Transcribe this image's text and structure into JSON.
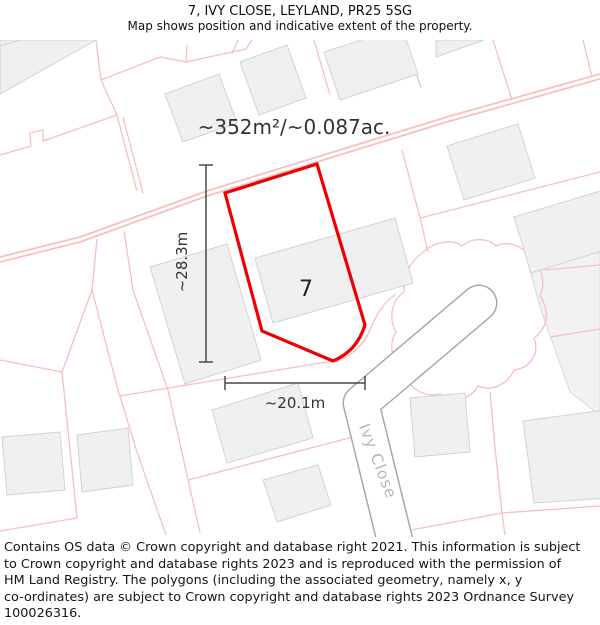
{
  "header": {
    "title": "7, IVY CLOSE, LEYLAND, PR25 5SG",
    "subtitle": "Map shows position and indicative extent of the property."
  },
  "map": {
    "area_label": "~352m²/~0.087ac.",
    "plot_number": "7",
    "dim_vertical_label": "~28.3m",
    "dim_horizontal_label": "~20.1m",
    "street_label": "Ivy Close",
    "colors": {
      "plot_outline": "#ee0000",
      "parcel_line": "#f8bfbf",
      "building_fill": "#f0f0f0",
      "building_stroke": "#d2d2d2",
      "road_casing": "#a8a8a8",
      "street_text": "#b6b6b6"
    }
  },
  "footer": {
    "lines": [
      "Contains OS data © Crown copyright and database right 2021. This information is subject",
      "to Crown copyright and database rights 2023 and is reproduced with the permission of",
      "HM Land Registry. The polygons (including the associated geometry, namely x, y",
      "co-ordinates) are subject to Crown copyright and database rights 2023 Ordnance Survey",
      "100026316."
    ]
  }
}
